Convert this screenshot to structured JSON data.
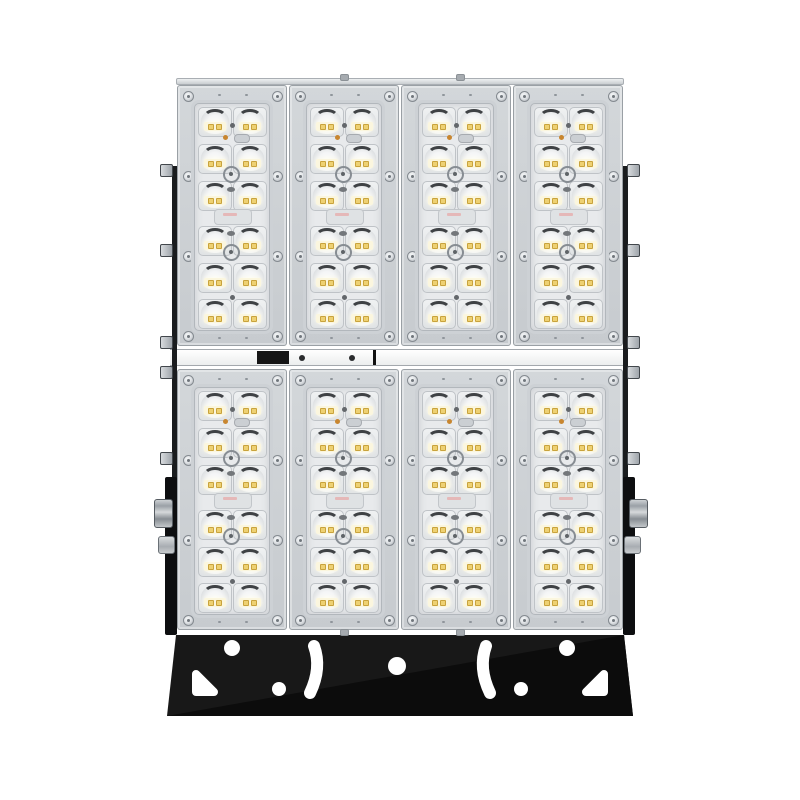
{
  "scene": {
    "type": "product-photo",
    "subject": "Modular LED floodlight, front view, on white background",
    "background_color": "#ffffff"
  },
  "fixture": {
    "module_grid": {
      "rows": 2,
      "columns": 4,
      "total_modules": 8
    },
    "leds_per_module": {
      "columns": 2,
      "rows": 6,
      "count": 12
    },
    "total_leds": 96,
    "colors": {
      "module_frame": "#c7cbcf",
      "module_frame_light": "#d3d7da",
      "module_border": "#9aa0a5",
      "lens_plate": "#e8eaec",
      "lens_body": "#eff1f2",
      "lens_arc_shadow": "#3f4245",
      "led_die": "#eed172",
      "bracket": "#181818",
      "bracket_shade": "#0c0c0c",
      "hardware": "#b9bec3",
      "divider": "#eceeee",
      "junction_block": "#161616"
    },
    "hardware": {
      "side_tabs_per_side": 5,
      "side_bolts_per_side": 2,
      "bracket_round_holes": 5,
      "bracket_arc_slots": 2,
      "bracket_corner_cutouts": 2
    }
  }
}
